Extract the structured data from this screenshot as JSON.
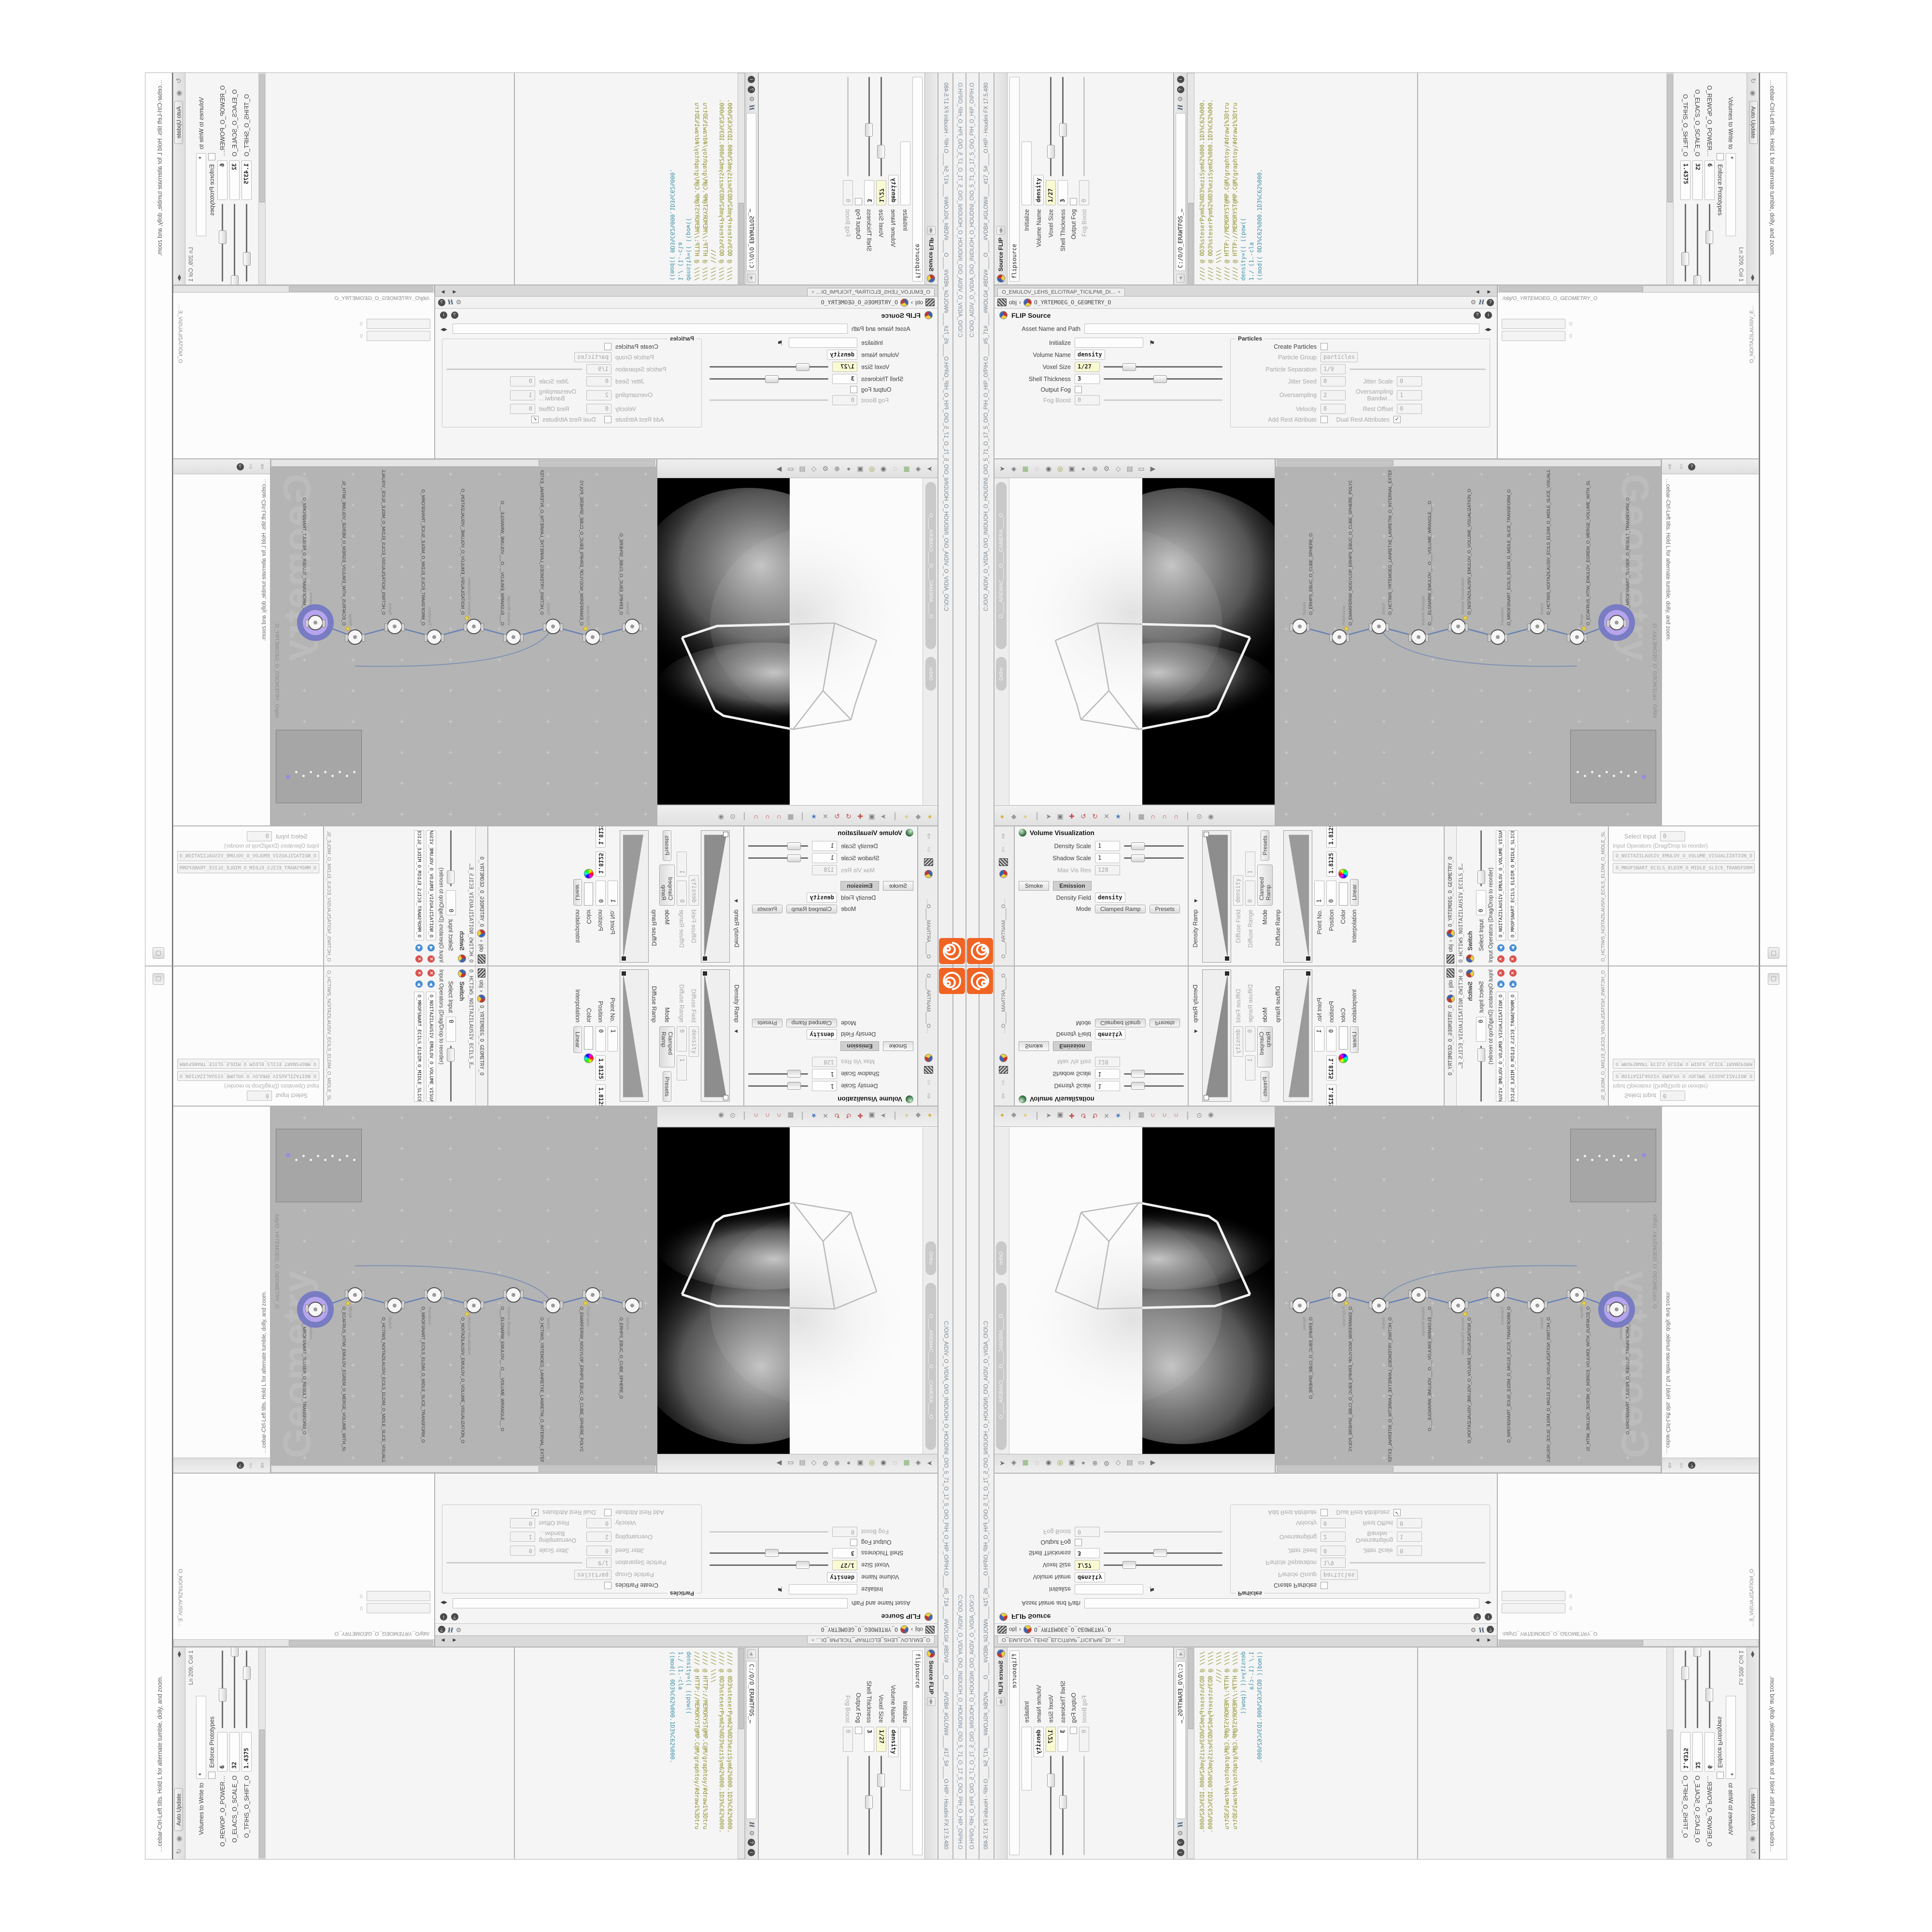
{
  "window": {
    "title": "C:/O/O_AIDIV_O_VIDIA_O/O_INIDUOH_O_HOUDINI_O/O_5_71_O_17_5_O/O_PIH_O_HIP_O/PIH.O____#5_71#____#WOLG#_#BDV#____O____#VDB#_#GLOW#____#17_5#____O.HIP - Houdini FX 17.5.480",
    "taskbar_path": "C:\\O\\O_AIDIV_O_VIDIA_O\\O_INIDUOH_O_HOUDINI_O\\O_5_71_O_17_5_O\\O_PIH_O_HIP_O\\PIH.O",
    "logo_color": "#f06423"
  },
  "statusbar": {
    "help": "…cebar-Ctrl-Left tilts. Hold L for alternate tumble, dolly, and zoom."
  },
  "viewport": {
    "camera": "O____AREMAC____O____CAMERA____O",
    "projection": "Ortho"
  },
  "pathbar": {
    "context": "obj",
    "chevron": "›",
    "path": "O_YRTEMOEG_O_GEOMETRY_O"
  },
  "tabs": {
    "flip_pane": "O_EMULOV_LEHS_ELCITRAP_TICILPMI_DI…",
    "vis_pane": "O_NOITAZILAUSIV_E…",
    "mantra_pane": "O____ARTNAM____O…",
    "switch_pane": "O_HCTIWS_NOITAZILAUSIV_ECILS_ELDIM_O_MIDLE_SLICE…"
  },
  "flip": {
    "title": "FLIP Source",
    "node_title": "Source FLIP",
    "name_field": "flipsource",
    "asset_label": "Asset Name and Path",
    "rows": [
      {
        "label": "Initialize",
        "value": ""
      },
      {
        "label": "Volume Name",
        "value": "density"
      },
      {
        "label": "Voxel Size",
        "value": "1/27"
      },
      {
        "label": "Shell Thickness",
        "value": "3"
      },
      {
        "label": "Output Fog",
        "value": ""
      },
      {
        "label": "Fog Boost",
        "value": "0"
      }
    ],
    "particles_section": "Particles",
    "particle_rows": [
      {
        "label": "Create Particles",
        "value": ""
      },
      {
        "label": "Particle Group",
        "value": "particles"
      },
      {
        "label": "Particle Separation",
        "value": "1/9"
      },
      {
        "label": "Jitter Seed",
        "value": "0"
      },
      {
        "label": "Jitter Scale",
        "value": "0"
      },
      {
        "label": "Oversampling",
        "value": "2"
      },
      {
        "label": "Oversampling Bandwi…",
        "value": "1"
      },
      {
        "label": "Velocity",
        "value": "0"
      },
      {
        "label": "Add Rest Attribute",
        "value": ""
      },
      {
        "label": "Dual Rest Attributes",
        "value": ""
      },
      {
        "label": "Rest Offset",
        "value": "0"
      }
    ]
  },
  "wrangle": {
    "title": "Volume Wrangle",
    "name_field": "volumewrangle",
    "asset_label": "Asset Name and Path",
    "path_field": "C:/O/O_ERAWTFOS_…",
    "code_lines": [
      "//// @ 0D3%steserPym62%0D3%eziSym62%000.1D3%C62%000.",
      "//// @ 0D3%steserPym62%0D3%eziSym62%000.1D3%C62%000.",
      "//// \\\\\\\\",
      "//// @ HTTP://MEMORYST@MP.C@M/graphtoy/#draw1%3Dtru",
      "//// @ HTTP://MEMORYST@MP.C@M/graphtoy/#draw1%3Dtru",
      "density=(( ((pow((",
      "1./ (1.-cla",
      "((mod(( 0D3%C62%000.1D3%C62%000."
    ]
  },
  "autoupdate": {
    "header": "Auto Update",
    "status": "Ln 209, Col 1",
    "enforce": "Enforce Prototypes",
    "volumes_label": "Volumes to Write to",
    "volumes_value": "*",
    "params": [
      {
        "label": "O_REWOP_O_POWER…",
        "value": "6",
        "pos": 34
      },
      {
        "label": "O_ELACS_O_SCALE_O",
        "value": "32",
        "pos": 92
      },
      {
        "label": "O_TFIHS_O_SHIFT_O",
        "value": "1.4375",
        "pos": 62
      }
    ]
  },
  "network": {
    "path": "/obj/O_YRTEMOEG_O_GEOMETRY_O",
    "watermark": "Geometry",
    "nodes": [
      {
        "type": "Sphere",
        "name": "O_ERHPS_EBUC_O_CUBE_SPHERE_O",
        "selected": false
      },
      {
        "type": "PolyFrame",
        "name": "O_EMARFERIW_NOGYLOP_ERHPS_EBUC_O_CUBE_SPHERE_POLYGON_WIREFRAME_O",
        "selected": false
      },
      {
        "type": "Switch",
        "name": "O_HCTIWS_YRTEMOEG_LANRETXE_LANRETNI_O_INTERNAL_EXTERNAL_GEOMETRY_SWITCH_O",
        "selected": false
      },
      {
        "type": "Volume Wrangle",
        "name": "O___ELGNARW_EMULOV___O___VOLUME_WRANGLE___O",
        "selected": false
      },
      {
        "type": "Volume Visualization",
        "name": "O_NOITAZILAUSIV_EMULOV_O_VOLUME_VISUALIZATION_O",
        "selected": false
      },
      {
        "type": "Transform",
        "name": "O_MROFSNART_ECILS_ELDIM_O_MIDLE_SLICE_TRANSFORM_O",
        "selected": false
      },
      {
        "type": "Switch",
        "name": "O_HCTIWS_NOITAZILAUSIV_ECILS_ELDIM_O_MIDLE_SLICE_VISUALIZATION_SWITCH_O",
        "selected": false
      },
      {
        "type": "Merge",
        "name": "O_ECAFRUS_HTIW_EMULOV_EGREM_O_MERGE_VOLUME_WITH_SURFACE_O",
        "selected": false
      },
      {
        "type": "Transform",
        "name": "O_MROFSNART_TLUSER_O_RESULT_TRANSFORM_O",
        "selected": true
      }
    ]
  },
  "volvis": {
    "title": "Volume Visualization",
    "tabs": [
      "Smoke",
      "Emission"
    ],
    "rows": [
      {
        "label": "Density Scale",
        "value": "1"
      },
      {
        "label": "Shadow Scale",
        "value": "1"
      },
      {
        "label": "Max Vis Res",
        "value": "128"
      }
    ],
    "density_field_label": "Density Field",
    "density_field_value": "density",
    "mode_label": "Mode",
    "mode_value": "Clamped Ramp",
    "presets": "Presets",
    "density_ramp_label": "Density Ramp",
    "diffuse_field_label": "Diffuse Field",
    "diffuse_field_value": "density",
    "diffuse_range_label": "Diffuse Range",
    "diffuse_range_min": "0",
    "diffuse_range_max": "1",
    "diffuse_ramp_label": "Diffuse Ramp",
    "point_label": "Point No.",
    "point_value": "1",
    "position_label": "Position",
    "position_value": "0",
    "color_label": "Color",
    "interp_label": "Interpolation",
    "interp_value": "Linear",
    "values": [
      "1.8125",
      "1.8125",
      "1.8125"
    ]
  },
  "switch": {
    "title": "Switch",
    "node_line": "O_HCTIWS_NOITAZILAUSIV_ECILS_E…",
    "select_label": "Select Input",
    "select_value": "0",
    "list_label": "Input Operators (Drag/Drop to reorder)",
    "items": [
      "O_NOITAZILAUSIV_EMULOV_O_VOLUME_VISUALIZATION_O",
      "O_MROFSNART_ECILS_ELDIM_O_MIDLE_SLICE_TRANSFORM_O"
    ]
  },
  "icons": {
    "viewport_top": [
      {
        "n": "select-arrow",
        "g": "➤",
        "c": "#6f6f6f"
      },
      {
        "n": "diamond-handle",
        "g": "◈",
        "c": "#777777"
      },
      {
        "n": "snap-plane",
        "g": "▦",
        "c": "#7fae6a"
      },
      {
        "n": "lasso",
        "g": "◌",
        "c": "#888888"
      },
      {
        "n": "view-pin",
        "g": "◉",
        "c": "#6f6f6f"
      },
      {
        "n": "light",
        "g": "◎",
        "c": "#9a9a3a"
      },
      {
        "n": "camera-tool",
        "g": "▣",
        "c": "#777777"
      },
      {
        "n": "shade-sphere",
        "g": "●",
        "c": "#8f8f8f"
      },
      {
        "n": "add-sphere",
        "g": "⊕",
        "c": "#777777"
      },
      {
        "n": "wrench",
        "g": "⚙",
        "c": "#808080"
      },
      {
        "n": "probe",
        "g": "◇",
        "c": "#888888"
      },
      {
        "n": "measure",
        "g": "▤",
        "c": "#888888"
      },
      {
        "n": "render-region",
        "g": "▭",
        "c": "#777777"
      },
      {
        "n": "flipbook",
        "g": "▶",
        "c": "#6f6f6f"
      }
    ],
    "viewport_bottom": [
      {
        "n": "shade-smooth",
        "g": "●",
        "c": "#d9b545"
      },
      {
        "n": "shade-flat",
        "g": "◆",
        "c": "#9a9a9a"
      },
      {
        "n": "shade-wire",
        "g": "●",
        "c": "#ded28a"
      },
      {
        "n": "divider",
        "g": "┃",
        "c": "#b5b5b5"
      },
      {
        "n": "select-mode",
        "g": "➤",
        "c": "#8a8a8a"
      },
      {
        "n": "secure-select",
        "g": "▣",
        "c": "#7f7f7f"
      },
      {
        "n": "move-tool",
        "g": "✚",
        "c": "#c0504d"
      },
      {
        "n": "rotate-tool",
        "g": "↺",
        "c": "#c0504d"
      },
      {
        "n": "scale-tool",
        "g": "↻",
        "c": "#c0504d"
      },
      {
        "n": "cut-tool",
        "g": "✕",
        "c": "#8a8a8a"
      },
      {
        "n": "axis-star",
        "g": "★",
        "c": "#4f7ec0"
      },
      {
        "n": "divider",
        "g": "┃",
        "c": "#b5b5b5"
      },
      {
        "n": "snap-window",
        "g": "▦",
        "c": "#8a8a8a"
      },
      {
        "n": "snap-magnet-point",
        "g": "∩",
        "c": "#c0504d"
      },
      {
        "n": "snap-magnet-prim",
        "g": "∩",
        "c": "#c0504d"
      },
      {
        "n": "snap-magnet-grid",
        "g": "∩",
        "c": "#c0504d"
      },
      {
        "n": "divider",
        "g": "┃",
        "c": "#b5b5b5"
      },
      {
        "n": "binoculars",
        "g": "⊙",
        "c": "#8a8a8a"
      },
      {
        "n": "spiral-sphere",
        "g": "◉",
        "c": "#8a8a8a"
      }
    ]
  }
}
